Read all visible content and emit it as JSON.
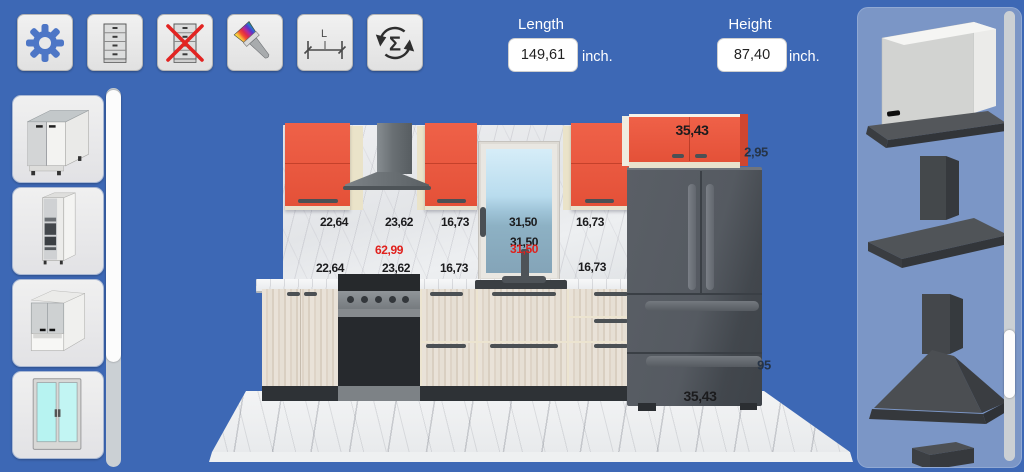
{
  "toolbar": {
    "buttons": [
      {
        "id": "settings",
        "icon": "gear-icon"
      },
      {
        "id": "add-cabinet",
        "icon": "cabinet-icon"
      },
      {
        "id": "delete-cabinet",
        "icon": "delete-cabinet-icon"
      },
      {
        "id": "paint",
        "icon": "paint-brush-icon"
      },
      {
        "id": "measure",
        "icon": "measure-length-icon"
      },
      {
        "id": "recalculate",
        "icon": "sigma-refresh-icon"
      }
    ]
  },
  "dimensions": {
    "length": {
      "label": "Length",
      "value": "149,61",
      "unit": "inch."
    },
    "height": {
      "label": "Height",
      "value": "87,40",
      "unit": "inch."
    }
  },
  "left_sidebar": {
    "items": [
      {
        "id": "base-cabinet",
        "icon": "base-cabinet-icon"
      },
      {
        "id": "tall-cabinet",
        "icon": "tall-cabinet-icon"
      },
      {
        "id": "wall-cabinet",
        "icon": "wall-cabinet-icon"
      },
      {
        "id": "window",
        "icon": "window-icon"
      }
    ]
  },
  "right_sidebar": {
    "items": [
      {
        "id": "built-in-hood",
        "icon": "built-in-hood-icon"
      },
      {
        "id": "flat-canopy-hood",
        "icon": "flat-canopy-hood-icon"
      },
      {
        "id": "pyramid-hood",
        "icon": "pyramid-hood-icon"
      },
      {
        "id": "next-hood-partial",
        "icon": "box-hood-icon"
      }
    ]
  },
  "scene": {
    "measurements": [
      {
        "text": "22,64",
        "x": 334,
        "y": 222,
        "size": 12,
        "color": "#1b1b1d"
      },
      {
        "text": "23,62",
        "x": 399,
        "y": 222,
        "size": 12,
        "color": "#1b1b1d"
      },
      {
        "text": "16,73",
        "x": 455,
        "y": 222,
        "size": 12,
        "color": "#1b1b1d"
      },
      {
        "text": "31,50",
        "x": 523,
        "y": 222,
        "size": 12,
        "color": "#1b1b1d"
      },
      {
        "text": "16,73",
        "x": 590,
        "y": 222,
        "size": 12,
        "color": "#1b1b1d"
      },
      {
        "text": "62,99",
        "x": 389,
        "y": 250,
        "size": 12,
        "color": "#e0201c"
      },
      {
        "text": "31,50",
        "x": 524,
        "y": 242,
        "size": 12,
        "color": "#1b1b1d"
      },
      {
        "text": "31,50",
        "x": 524,
        "y": 249,
        "size": 12,
        "color": "#e0201c"
      },
      {
        "text": "22,64",
        "x": 330,
        "y": 268,
        "size": 12,
        "color": "#1b1b1d"
      },
      {
        "text": "23,62",
        "x": 396,
        "y": 268,
        "size": 12,
        "color": "#1b1b1d"
      },
      {
        "text": "16,73",
        "x": 454,
        "y": 268,
        "size": 12,
        "color": "#1b1b1d"
      },
      {
        "text": "16,73",
        "x": 592,
        "y": 267,
        "size": 12,
        "color": "#1b1b1d"
      },
      {
        "text": "35,43",
        "x": 692,
        "y": 130,
        "size": 14,
        "color": "#1b1b1d"
      },
      {
        "text": "2,95",
        "x": 756,
        "y": 152,
        "size": 13,
        "color": "#263447"
      },
      {
        "text": "95",
        "x": 764,
        "y": 365,
        "size": 13,
        "color": "#263447"
      },
      {
        "text": "35,43",
        "x": 700,
        "y": 396,
        "size": 14,
        "color": "#1b1b1d"
      }
    ]
  },
  "colors": {
    "background": "#3d68b5",
    "side_panel": "#7b96c6",
    "cabinet_orange": "#e45741",
    "label_black": "#1b1b1d",
    "label_red": "#e0201c",
    "label_slate": "#263447"
  }
}
